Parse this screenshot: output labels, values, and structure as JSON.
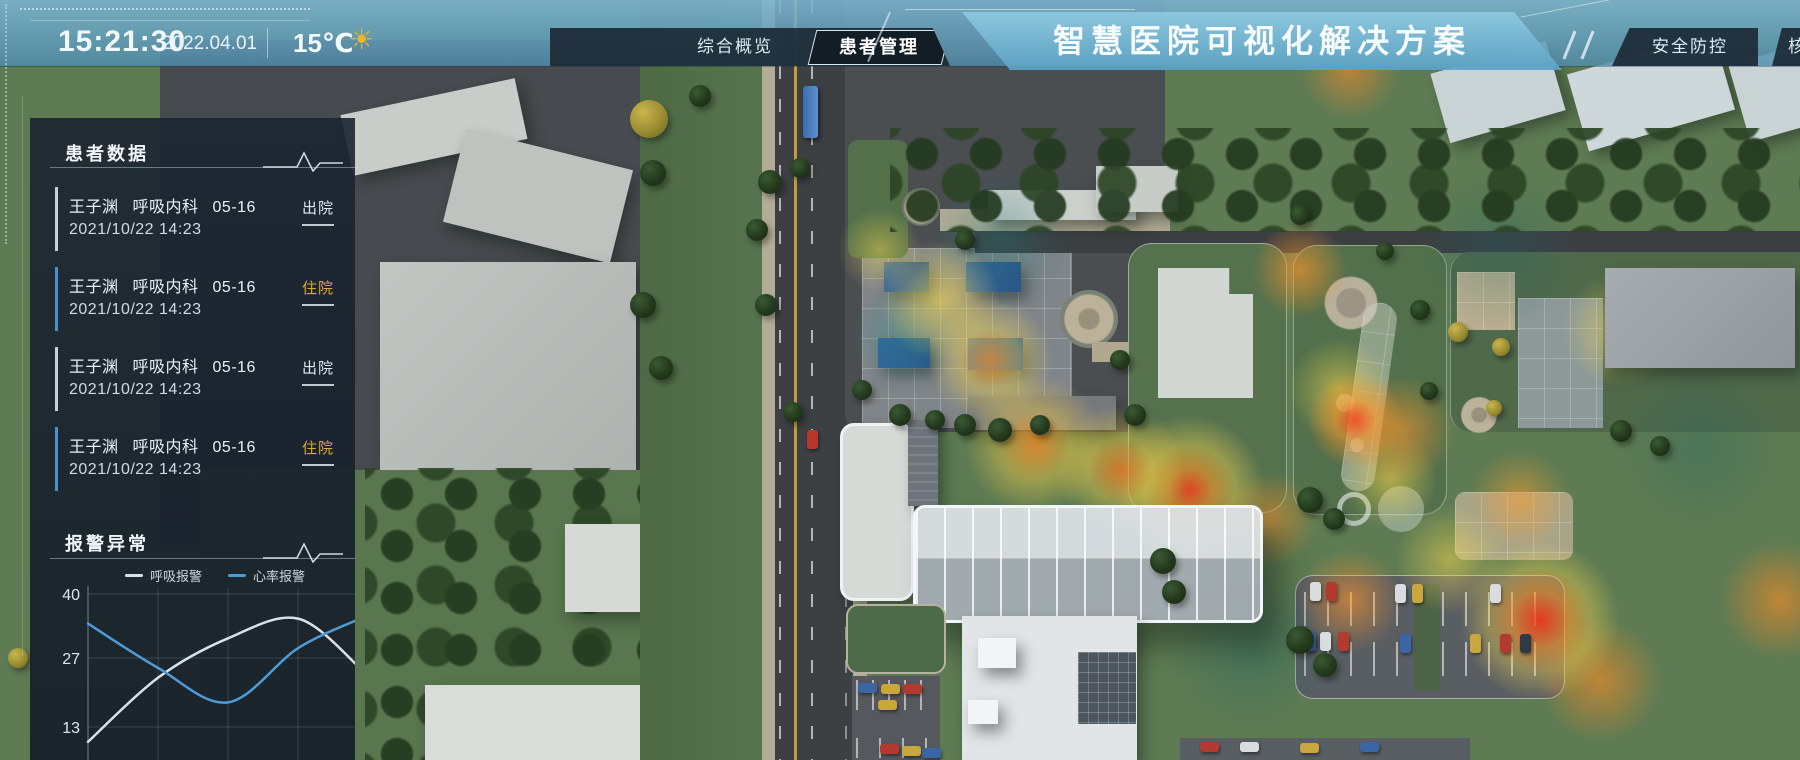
{
  "header": {
    "time": "15:21:30",
    "date": "2022.04.01",
    "temperature": "15℃",
    "weather_icon": "sun",
    "nav_left": [
      {
        "label": "综合概览",
        "active": false
      },
      {
        "label": "患者管理",
        "active": true
      }
    ],
    "title": "智慧医院可视化解决方案",
    "nav_right": [
      {
        "label": "安全防控",
        "active": false
      },
      {
        "label": "核",
        "active": false,
        "clipped": true
      }
    ]
  },
  "patient_panel": {
    "title": "患者数据",
    "items": [
      {
        "name": "王子渊",
        "dept": "呼吸内科",
        "bed": "05-16",
        "time": "2021/10/22 14:23",
        "status": "出院"
      },
      {
        "name": "王子渊",
        "dept": "呼吸内科",
        "bed": "05-16",
        "time": "2021/10/22 14:23",
        "status": "住院"
      },
      {
        "name": "王子渊",
        "dept": "呼吸内科",
        "bed": "05-16",
        "time": "2021/10/22 14:23",
        "status": "出院"
      },
      {
        "name": "王子渊",
        "dept": "呼吸内科",
        "bed": "05-16",
        "time": "2021/10/22 14:23",
        "status": "住院"
      }
    ]
  },
  "alarm_panel": {
    "title": "报警异常",
    "legend": [
      {
        "label": "呼吸报警",
        "color": "#c3ced6"
      },
      {
        "label": "心率报警",
        "color": "#4f9bd8"
      }
    ]
  },
  "chart_data": {
    "type": "line",
    "title": "报警异常",
    "x": [
      0,
      1,
      2,
      3,
      4
    ],
    "xlabel": "",
    "ylabel": "",
    "series": [
      {
        "name": "呼吸报警",
        "color": "#d7e2ea",
        "values": [
          10,
          23,
          31,
          35,
          25
        ]
      },
      {
        "name": "心率报警",
        "color": "#4f9bd8",
        "values": [
          34,
          25,
          18,
          29,
          35
        ]
      }
    ],
    "yticks": [
      40,
      27,
      13
    ],
    "ylim": [
      8,
      42
    ],
    "grid": true,
    "legend_position": "top",
    "note": "x axis labels cropped below screen edge"
  },
  "colors": {
    "accent_blue": "#4f9bd8",
    "line_gray": "#d7e2ea",
    "badge_gold": "#d9a93c",
    "badge_light": "#dde7ee",
    "header_blue": "#6fb0cf",
    "panel_bg": "#1a2330"
  }
}
